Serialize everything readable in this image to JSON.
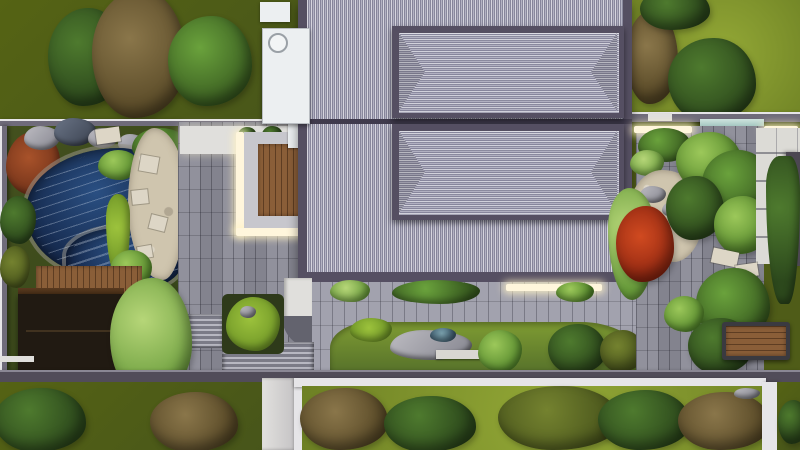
{
  "meta": {
    "kind": "top-down 3d landscape render",
    "description": "aerial view of a courtyard-garden residence with tiled roofs, koi pond, wood deck, stone paths and lawns",
    "canvas": {
      "width": 800,
      "height": 450
    }
  },
  "palette": {
    "olive_lawn": "#4f5c18",
    "bright_lawn": "#819a2c",
    "roof_frame": "#554f62",
    "roof_tile": "#a3a2b6",
    "paving": "#8b8b97",
    "paving_light": "#a2a2ae",
    "paving_pale": "#e0dfdc",
    "wall_gray": "#6f6b7a",
    "wall_light": "#e6e5e8",
    "gravel": "#cfc5ae",
    "paver_white": "#ddd6c6",
    "wood": "#8a5e38",
    "wood_dark": "#5e3d22",
    "pavilion_dark": "#211a12",
    "water_deep": "#132547",
    "maple_red": "#b23418",
    "glow": "#fff6dc",
    "white_structure": "#eceff1",
    "glass_teal": "#9fc3bd"
  },
  "scene": {
    "building": {
      "label": "main-house-tiled-roof",
      "bays": 2,
      "raised_hip_roofs": 2
    },
    "water_feature": {
      "label": "koi-pond-with-rock-edge"
    },
    "structures": [
      "wood-deck",
      "dark-flat-roof-pavilion",
      "white-utility-annex",
      "garden-bench",
      "glass-entry-canopy"
    ],
    "paths": [
      "gray-plank-paving",
      "beige-gravel-stepping-path",
      "white-tile-side-path",
      "white-walkway",
      "stairs"
    ],
    "planting": [
      "olive-lawn-with-trees",
      "bright-lawn-with-trees",
      "red-maple",
      "rust-shrub",
      "mixed-shrub-beds",
      "moss-mound"
    ],
    "lighting": [
      "l-shaped-deck-light-strip",
      "step-light-strip",
      "wall-wash-lights"
    ]
  }
}
